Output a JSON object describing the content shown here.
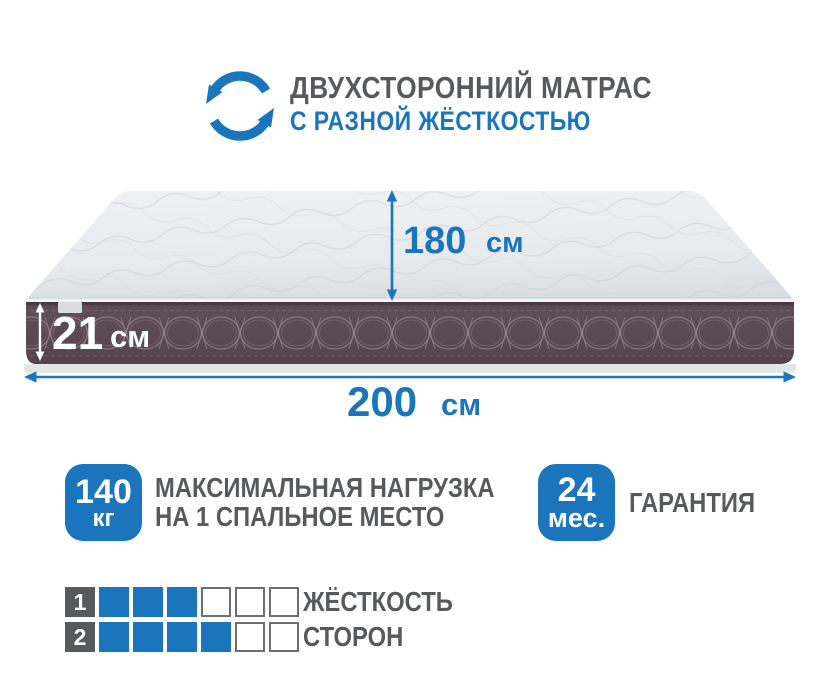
{
  "header": {
    "title": "ДВУХСТОРОННИЙ МАТРАС",
    "subtitle": "С РАЗНОЙ ЖЁСТКОСТЬЮ",
    "icon": "rotate-arrows-icon"
  },
  "mattress": {
    "depth": {
      "value": "180",
      "unit": "см"
    },
    "height": {
      "value": "21",
      "unit": "см"
    },
    "width": {
      "value": "200",
      "unit": "см"
    }
  },
  "badges": {
    "max_load": {
      "value": "140",
      "unit": "кг",
      "line1": "МАКСИМАЛЬНАЯ НАГРУЗКА",
      "line2": "НА 1 СПАЛЬНОЕ МЕСТО"
    },
    "warranty": {
      "value": "24",
      "unit": "мес.",
      "label": "ГАРАНТИЯ"
    }
  },
  "ratings": {
    "label_line1": "ЖЁСТКОСТЬ",
    "label_line2": "СТОРОН",
    "rows": [
      {
        "index": "1",
        "filled": 3,
        "total": 6
      },
      {
        "index": "2",
        "filled": 4,
        "total": 6
      }
    ]
  },
  "colors": {
    "accent-blue": "#1b75bc",
    "text-gray": "#58595b",
    "side-dark": "#5b4a52",
    "top-light": "#e9ebed"
  }
}
